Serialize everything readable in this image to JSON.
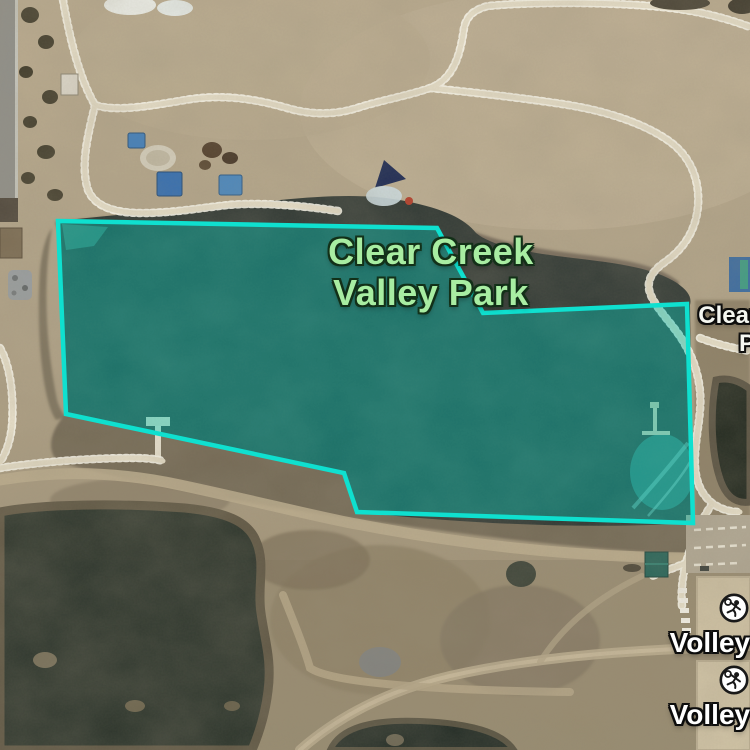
{
  "app": {
    "view": "satellite-map"
  },
  "park_label": {
    "line1": "Clear Creek",
    "line2": "Valley Park",
    "color": "#a8eda2",
    "outline_color": "#123018"
  },
  "adjacent_label": {
    "line1": "Clear Creek",
    "line2": "Park",
    "color": "#f5f7f1"
  },
  "markers": [
    {
      "id": "volleyball-1",
      "label": "Volleyball",
      "icon": "volleyball-player-icon"
    },
    {
      "id": "volleyball-2",
      "label": "Volleyball",
      "icon": "volleyball-player-icon"
    }
  ],
  "overlay": {
    "name": "park-area-highlight",
    "polygon_points": "58,221 437,228 483,313 687,304 693,523 357,512 344,473 66,414",
    "stroke_color": "#0fe0cf",
    "fill_color": "rgba(0,205,188,0.38)"
  },
  "terrain_features": {
    "lake": "lake-water",
    "ponds": "dark-ponds",
    "paths": "walking-path",
    "playground": "playground-structures",
    "courts": "volleyball-courts"
  }
}
